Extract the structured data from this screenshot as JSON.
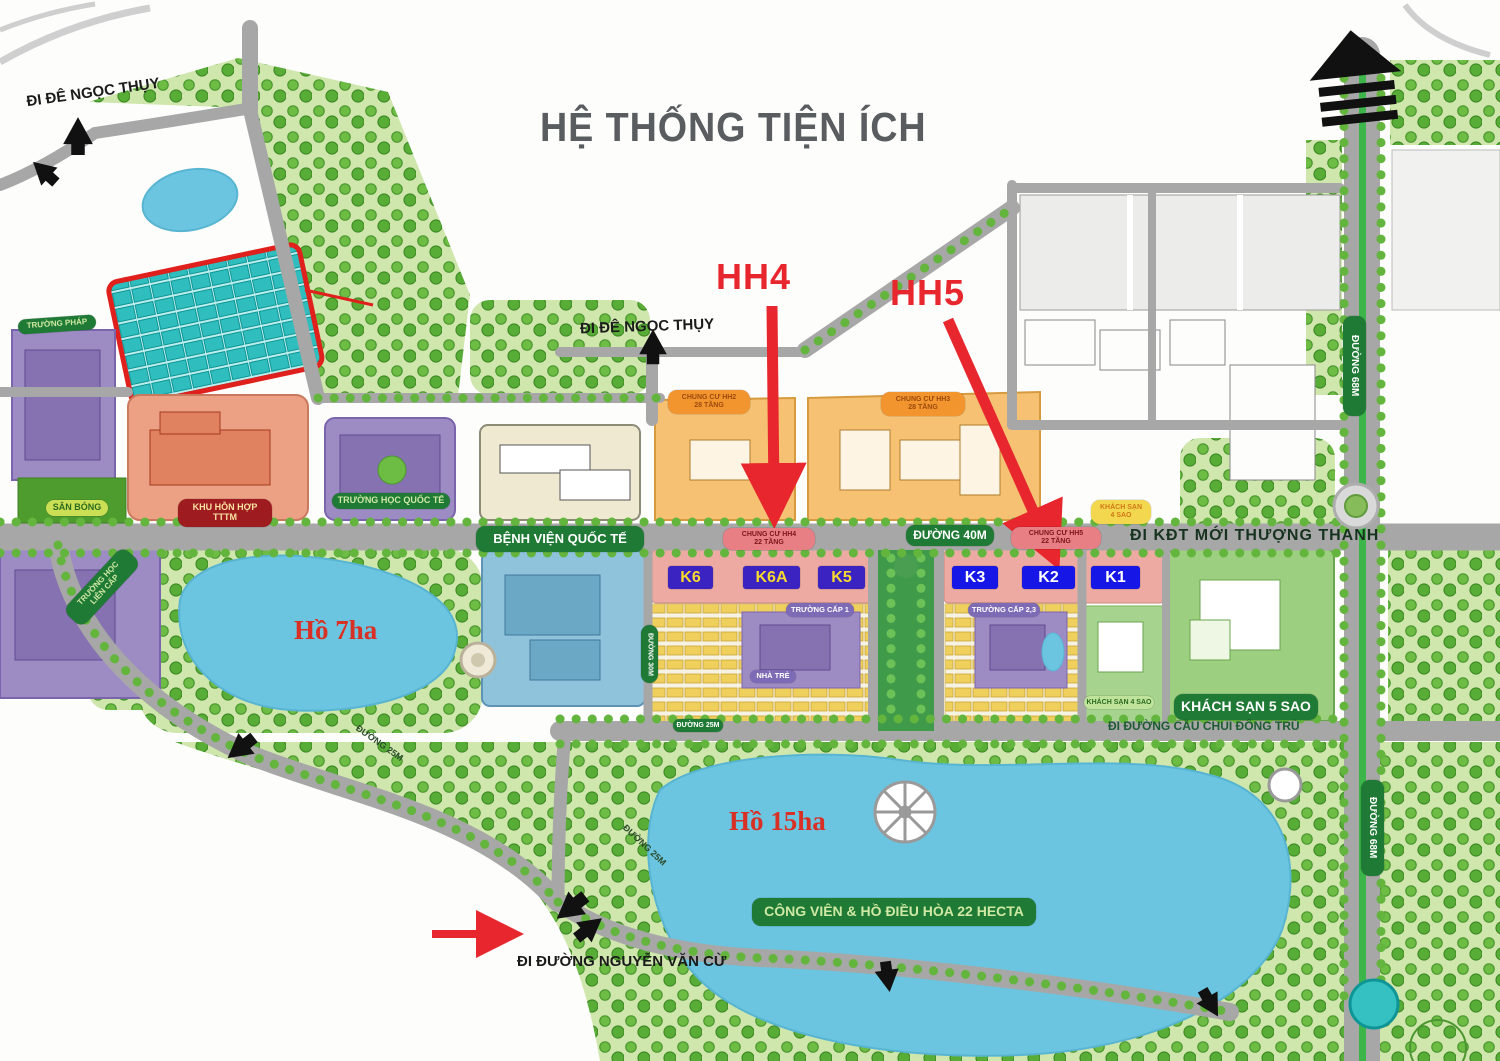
{
  "title": "HỆ THỐNG TIỆN ÍCH",
  "markers": {
    "hh4": "HH4",
    "hh5": "HH5"
  },
  "k_west": [
    "K6",
    "K6A",
    "K5"
  ],
  "k_east": [
    "K3",
    "K2",
    "K1"
  ],
  "lakes": {
    "ho_7ha": "Hồ 7ha",
    "ho_15ha": "Hồ 15ha"
  },
  "banners": {
    "truong_phap": "TRƯỜNG PHÁP",
    "san_bong": "SÂN BÓNG",
    "khu_hon_hop_line1": "KHU HỖN HỢP",
    "khu_hon_hop_line2": "TTTM",
    "truong_hoc_quoc_te": "TRƯỜNG HỌC QUỐC TẾ",
    "truong_hoc_lien_cap_line1": "TRƯỜNG HỌC",
    "truong_hoc_lien_cap_line2": "LIÊN CẤP",
    "benh_vien_quoc_te": "BỆNH VIỆN QUỐC TẾ",
    "chung_cu_hh2_line1": "CHUNG CƯ HH2",
    "chung_cu_hh2_line2": "28 TẦNG",
    "chung_cu_hh3_line1": "CHUNG CƯ HH3",
    "chung_cu_hh3_line2": "28 TẦNG",
    "chung_cu_hh4_line1": "CHUNG CƯ HH4",
    "chung_cu_hh4_line2": "22 TẦNG",
    "chung_cu_hh5_line1": "CHUNG CƯ HH5",
    "chung_cu_hh5_line2": "22 TẦNG",
    "truong_cap_1": "TRƯỜNG CẤP 1",
    "nha_tre": "NHÀ TRẺ",
    "truong_cap_23": "TRƯỜNG CẤP 2,3",
    "khach_san_4_sao_line1": "KHÁCH SẠN",
    "khach_san_4_sao_line2": "4 SAO",
    "khach_san_4_sao": "KHÁCH SẠN 4 SAO",
    "khach_san_5_sao": "KHÁCH SẠN 5 SAO",
    "cong_vien": "CÔNG VIÊN & HỒ ĐIỀU HÒA 22 HECTA"
  },
  "roads": {
    "di_de_ngoc_thuy": "ĐI ĐÊ NGỌC THỤY",
    "di_kdt_moi_thuong_thanh": "ĐI KĐT MỚI THƯỢNG THANH",
    "di_duong_cau_chui_dong_tru": "ĐI ĐƯỜNG CẦU CHUI ĐÔNG TRÙ",
    "di_duong_nguyen_van_cu": "ĐI ĐƯỜNG NGUYỄN VĂN CỪ",
    "duong_40m": "ĐƯỜNG 40M",
    "duong_68m": "ĐƯỜNG 68M",
    "duong_30m": "ĐƯỜNG 30M",
    "duong_25m": "ĐƯỜNG 25M"
  },
  "colors": {
    "accent_red": "#e8262d",
    "banner_green": "#1e7a34",
    "lake_blue": "#6cc5e0",
    "road_gray": "#a7a7a7",
    "k_west_bg": "#3a23c0",
    "k_west_text": "#f7d930",
    "k_east_bg": "#1616e6",
    "villa_teal": "#35c1c1",
    "chungcu_orange": "#f6c173",
    "strip_pink": "#ecaaa2"
  }
}
